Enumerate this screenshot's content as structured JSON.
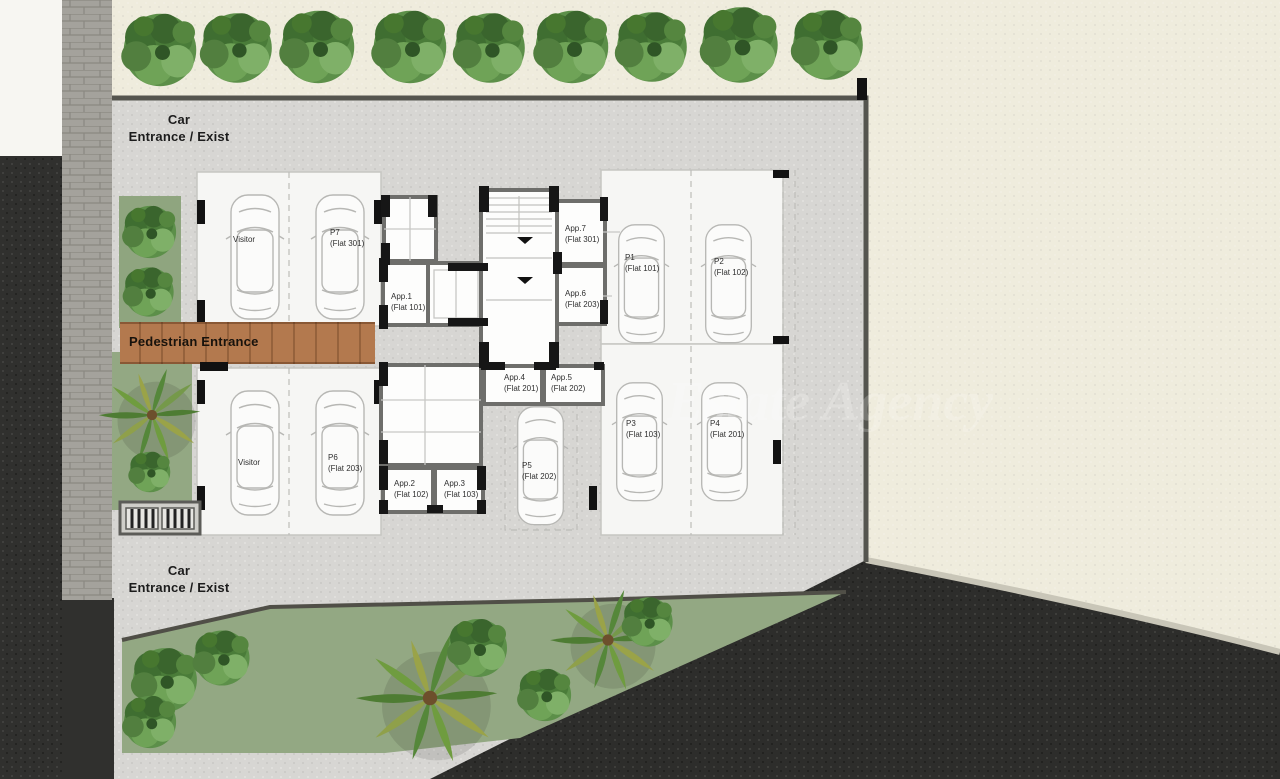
{
  "plan": {
    "car_entrance_top": {
      "line1": "Car",
      "line2": "Entrance / Exist"
    },
    "car_entrance_bottom": {
      "line1": "Car",
      "line2": "Entrance / Exist"
    },
    "pedestrian_entrance": {
      "label": "Pedestrian Entrance"
    },
    "watermark": "Estate Agency"
  },
  "parking_spots": [
    {
      "id": "Visitor",
      "flat": ""
    },
    {
      "id": "P7",
      "flat": "(Flat 301)"
    },
    {
      "id": "P1",
      "flat": "(Flat 101)"
    },
    {
      "id": "P2",
      "flat": "(Flat 102)"
    },
    {
      "id": "P3",
      "flat": "(Flat 103)"
    },
    {
      "id": "P4",
      "flat": "(Flat 201)"
    },
    {
      "id": "P5",
      "flat": "(Flat 202)"
    },
    {
      "id": "Visitor",
      "flat": ""
    },
    {
      "id": "P6",
      "flat": "(Flat 203)"
    }
  ],
  "apartments": [
    {
      "id": "App.1",
      "flat": "(Flat 101)"
    },
    {
      "id": "App.2",
      "flat": "(Flat 102)"
    },
    {
      "id": "App.3",
      "flat": "(Flat 103)"
    },
    {
      "id": "App.4",
      "flat": "(Flat 201)"
    },
    {
      "id": "App.5",
      "flat": "(Flat 202)"
    },
    {
      "id": "App.6",
      "flat": "(Flat 203)"
    },
    {
      "id": "App.7",
      "flat": "(Flat 301)"
    }
  ],
  "colors": {
    "pavement": "#d7d6d3",
    "cream_plot": "#efecdd",
    "asphalt": "#30302e",
    "grass": "#93a883",
    "walkway_wood": "#b3794e",
    "site_wall": "#55554f",
    "tree_green_dark": "#3f6e31",
    "tree_green_light": "#7fb068"
  }
}
